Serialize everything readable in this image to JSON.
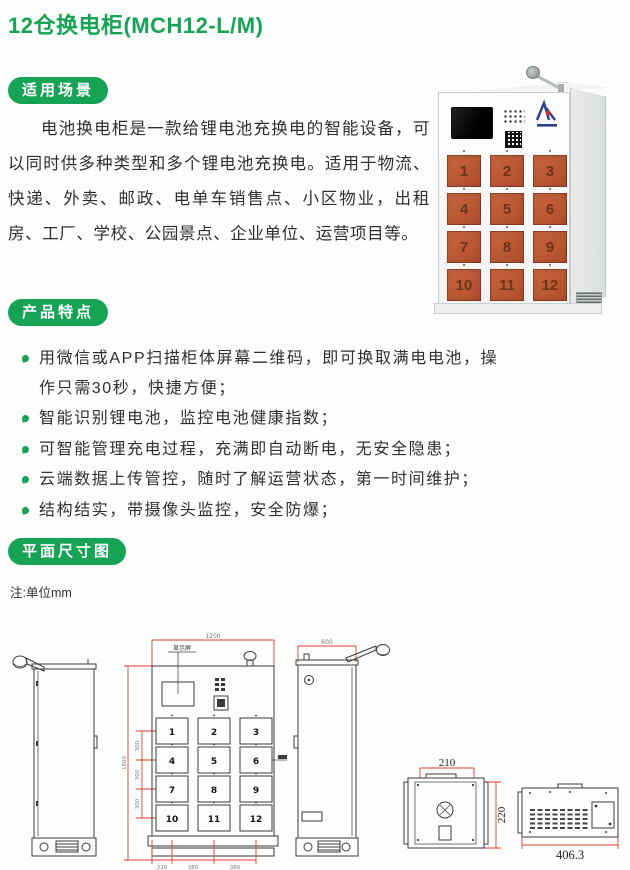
{
  "page_title": "12仓换电柜(MCH12-L/M)",
  "colors": {
    "brand_green": "#17a356",
    "door_orange": "#bc5a39",
    "dimension_red": "#e23b31"
  },
  "scenarios": {
    "badge": "适用场景",
    "body": "电池换电柜是一款给锂电池充换电的智能设备，可以同时供多种类型和多个锂电池充换电。适用于物流、快递、外卖、邮政、电单车销售点、小区物业，出租房、工厂、学校、公园景点、企业单位、运营项目等。"
  },
  "features": {
    "badge": "产品特点",
    "items": [
      "用微信或APP扫描柜体屏幕二维码，即可换取满电电池，操作只需30秒，快捷方便；",
      "智能识别锂电池，监控电池健康指数；",
      "可智能管理充电过程，充满即自动断电，无安全隐患；",
      "云端数据上传管控，随时了解运营状态，第一时间维护；",
      "结构结实，带摄像头监控，安全防爆；"
    ]
  },
  "dimensions_section": {
    "badge": "平面尺寸图",
    "note": "注:单位mm"
  },
  "door_numbers": [
    "1",
    "2",
    "3",
    "4",
    "5",
    "6",
    "7",
    "8",
    "9",
    "10",
    "11",
    "12"
  ],
  "drawings": {
    "front": {
      "top_width": "1200",
      "screen_label": "显示屏",
      "total_height": "1800",
      "row_heights": [
        "300",
        "300",
        "300"
      ],
      "bottom_widths": [
        "220",
        "380",
        "380"
      ]
    },
    "side": {
      "top_width": "600"
    },
    "box_front": {
      "width": "210",
      "height": "220"
    },
    "box_side": {
      "width": "406.3"
    }
  }
}
